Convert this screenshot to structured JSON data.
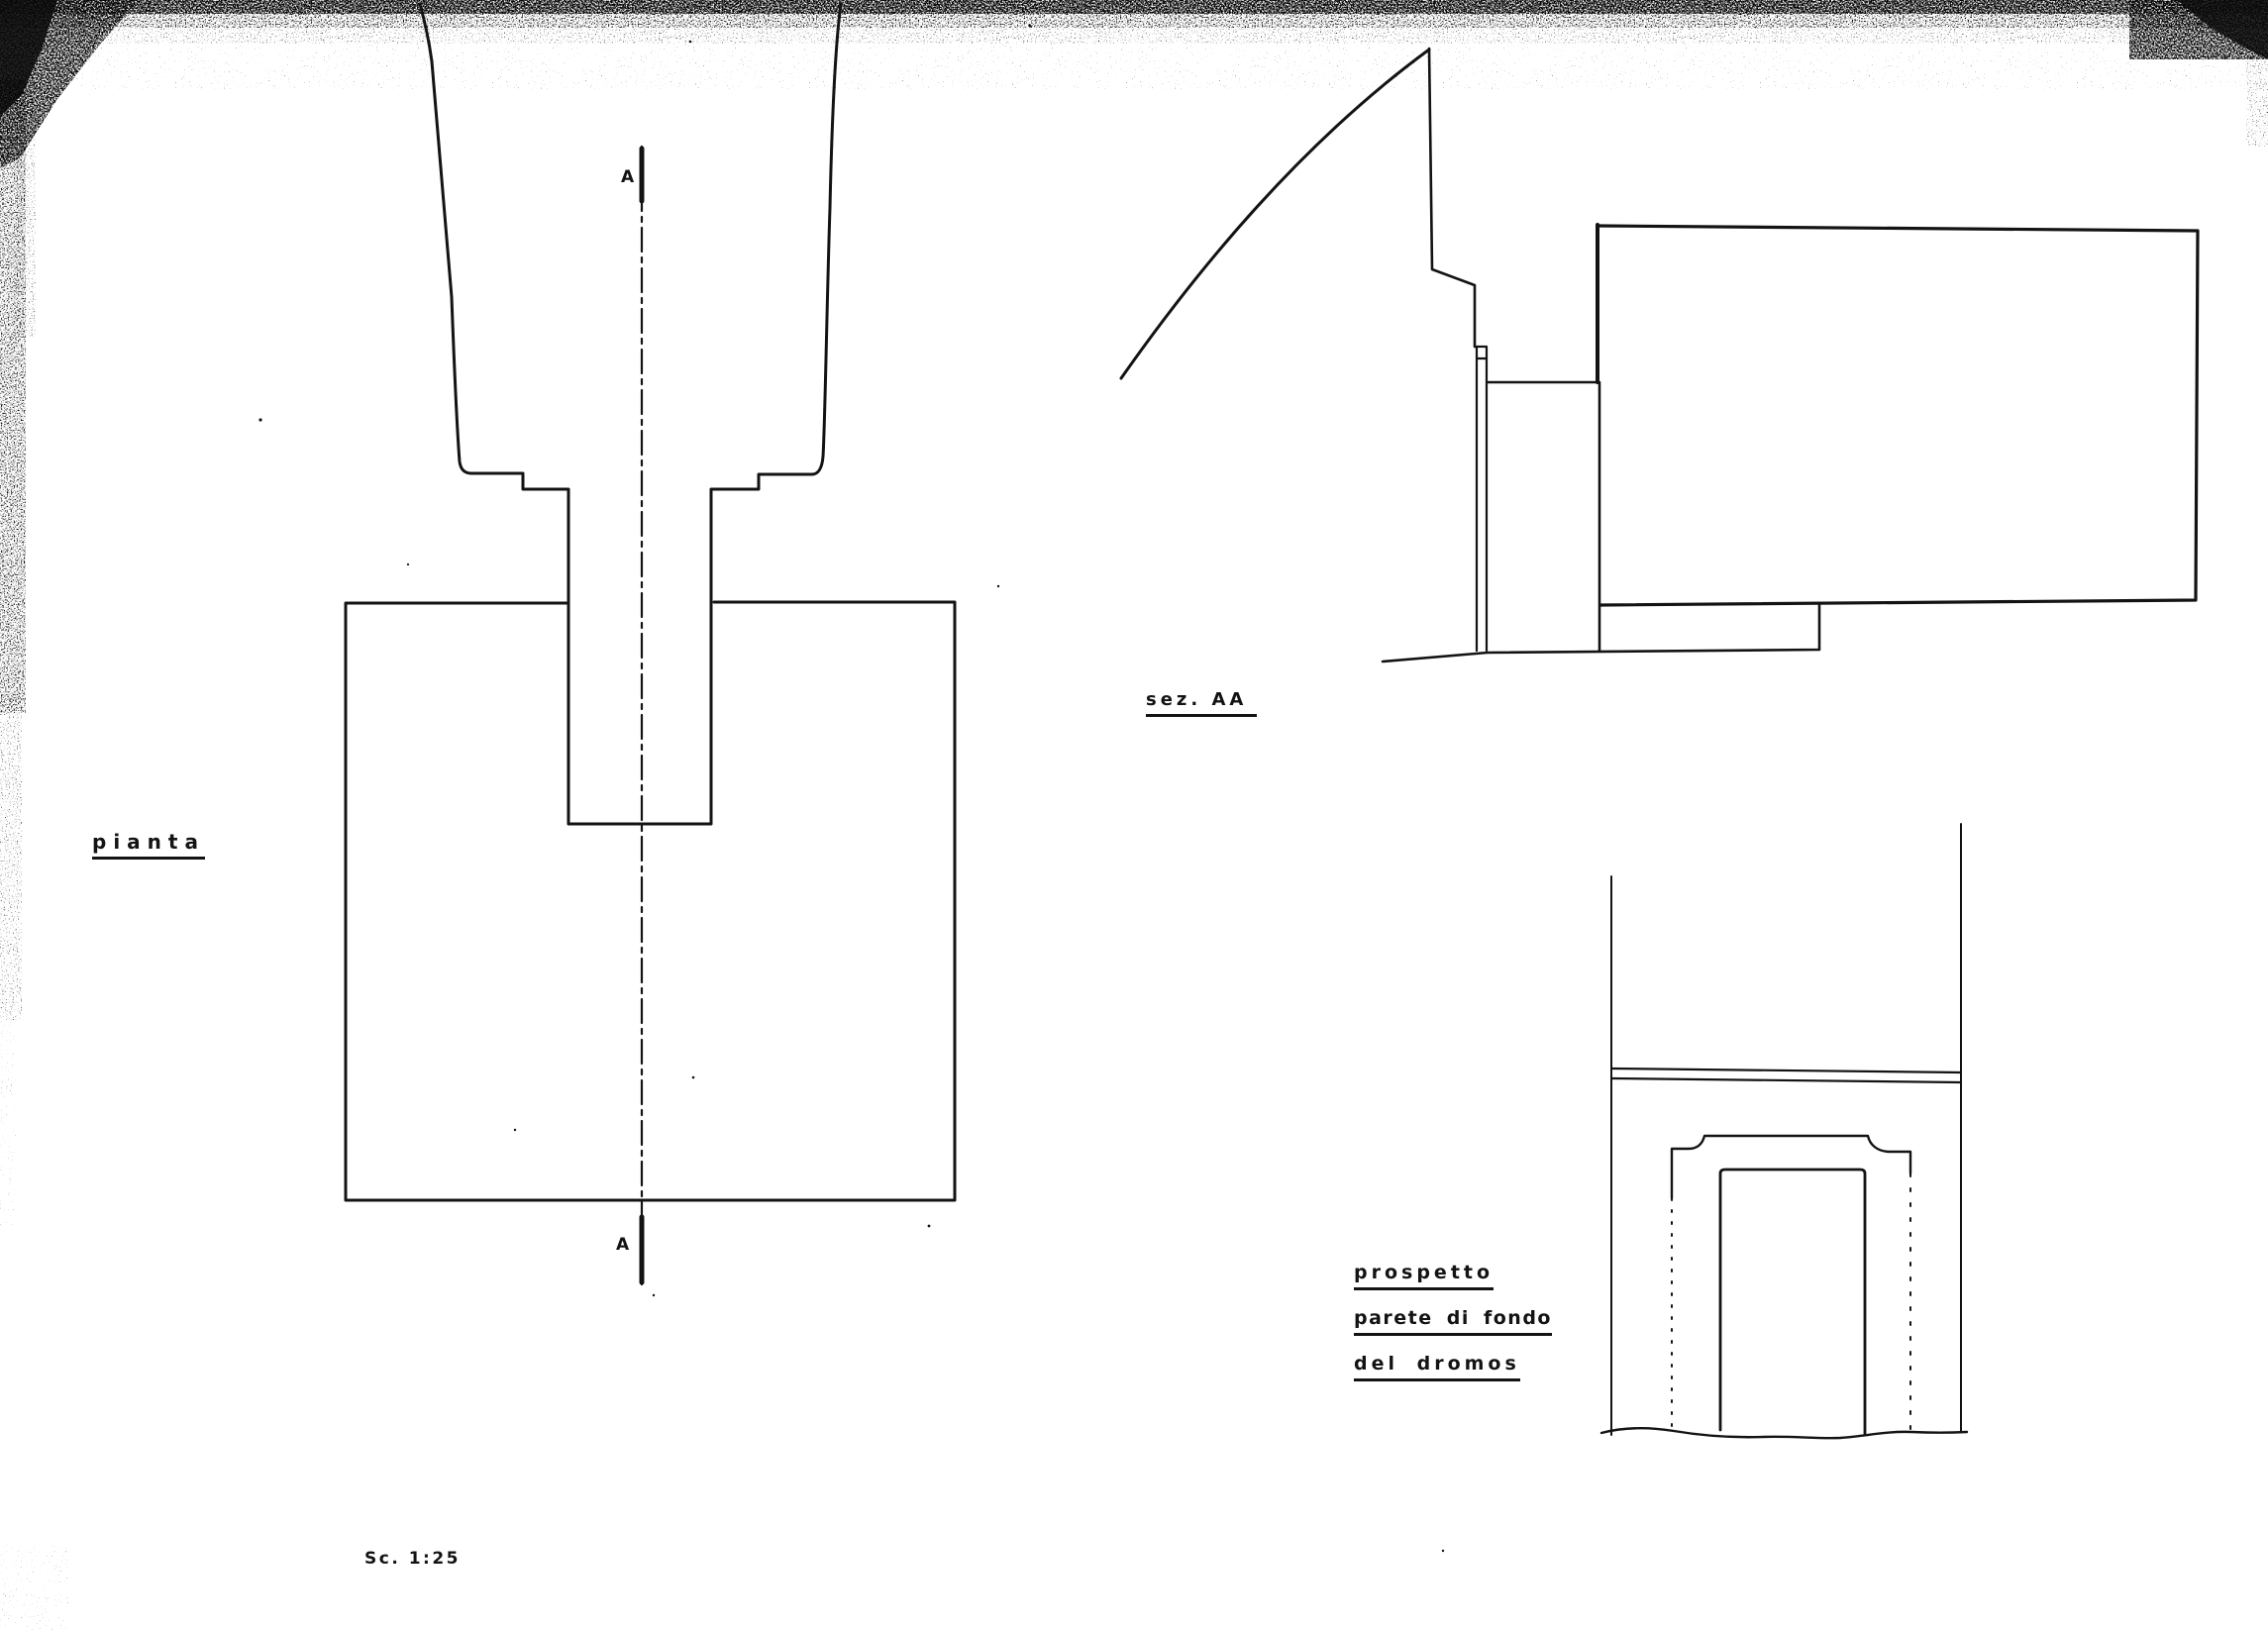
{
  "sheet": {
    "scale_label": "Sc. 1:25",
    "ink_color": "#131313",
    "paper_color": "#ffffff"
  },
  "labels": {
    "plan": "pianta",
    "section": "sez. AA",
    "elevation_line1": "prospetto",
    "elevation_line2": "parete di fondo",
    "elevation_line3": "del dromos"
  },
  "markers": {
    "section_top": "A",
    "section_bottom": "A"
  }
}
